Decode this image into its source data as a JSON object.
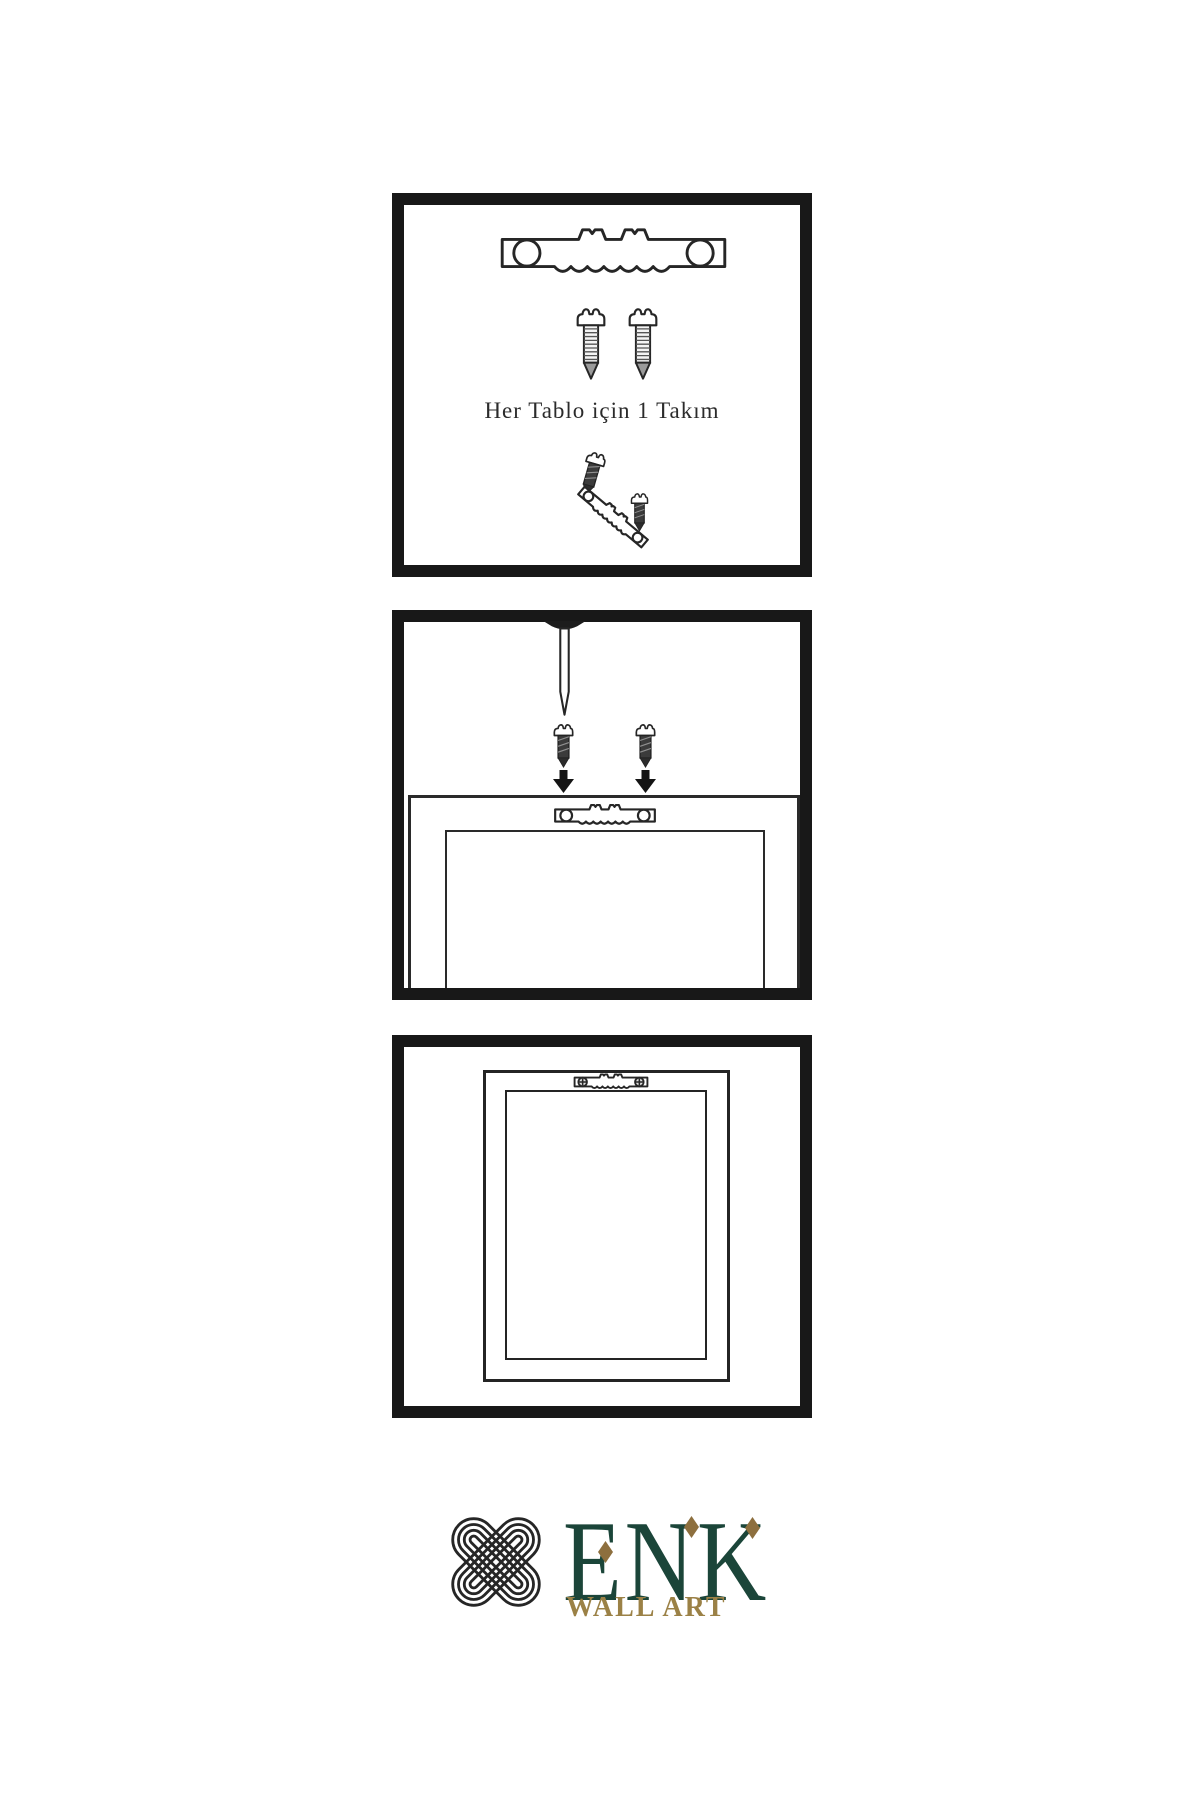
{
  "page": {
    "background": "#ffffff"
  },
  "steps": {
    "step1": {
      "caption": "Her Tablo için 1 Takım"
    },
    "step2": {
      "description_icons": [
        "nail-icon",
        "dark-screw-icon",
        "down-arrow-icon",
        "sawtooth-hanger-icon",
        "picture-frame-back-icon"
      ]
    },
    "step3": {
      "description_icons": [
        "sawtooth-hanger-mounted-icon",
        "picture-frame-hung-icon"
      ]
    }
  },
  "logo": {
    "brand": "ENK",
    "subtitle": "WALL ART"
  },
  "colors": {
    "ink": "#262626",
    "panel_border": "#181818",
    "brand_green": "#1b4539",
    "logo_gold": "#9b8146",
    "knot_gold": "#85774b",
    "diamond_gold": "#8d6f3e"
  },
  "icons": {
    "sawtooth_hanger": "sawtooth-hanger-icon",
    "screw": "screw-icon",
    "dark_screw": "dark-screw-icon",
    "nail": "nail-icon",
    "down_arrow": "down-arrow-icon",
    "picture_frame": "picture-frame-icon",
    "knot": "knot-logo-icon"
  }
}
